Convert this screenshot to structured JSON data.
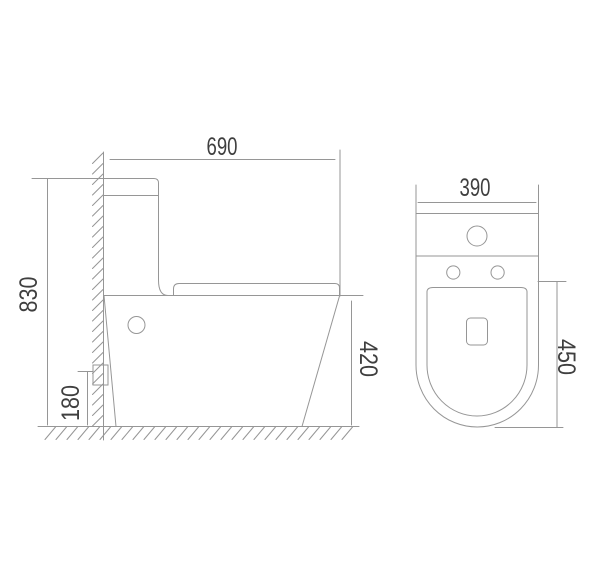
{
  "colors": {
    "line": "#969696",
    "text": "#3f3f3f",
    "background": "#ffffff"
  },
  "side_view": {
    "dimensions": {
      "depth_mm": "690",
      "height_mm": "830",
      "inlet_height_mm": "180",
      "bowl_height_mm": "420"
    }
  },
  "top_view": {
    "dimensions": {
      "width_mm": "390",
      "seat_length_mm": "450"
    }
  }
}
